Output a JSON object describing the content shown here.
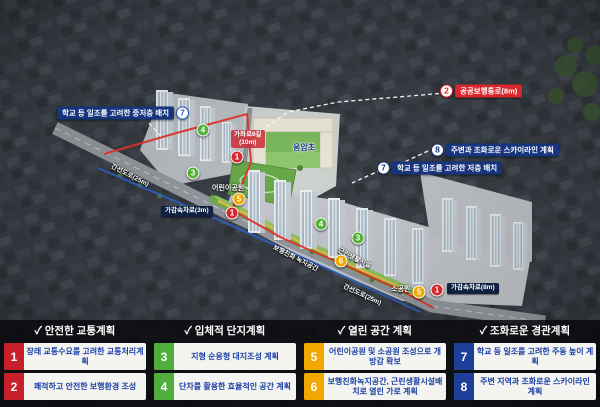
{
  "map": {
    "colors": {
      "red": "#d8272e",
      "green": "#55b03c",
      "yellow": "#f0a700",
      "navy": "#16357d",
      "blue": "#2457b8"
    },
    "markers": [
      {
        "n": "4",
        "color": "green",
        "x": 203,
        "y": 130
      },
      {
        "n": "1",
        "color": "red",
        "x": 237,
        "y": 157
      },
      {
        "n": "3",
        "color": "green",
        "x": 193,
        "y": 173
      },
      {
        "n": "5",
        "color": "yellow",
        "x": 239,
        "y": 199
      },
      {
        "n": "1",
        "color": "red",
        "x": 232,
        "y": 213
      },
      {
        "n": "4",
        "color": "green",
        "x": 321,
        "y": 224
      },
      {
        "n": "3",
        "color": "green",
        "x": 358,
        "y": 238
      },
      {
        "n": "6",
        "color": "yellow",
        "x": 341,
        "y": 261
      },
      {
        "n": "5",
        "color": "yellow",
        "x": 419,
        "y": 292
      },
      {
        "n": "1",
        "color": "red",
        "x": 437,
        "y": 290
      }
    ],
    "callouts": [
      {
        "num": "7",
        "text": "학교 등 일조를 고려한 중저층 배치",
        "x": 57,
        "y": 113,
        "color": "#16357d",
        "num_color": "#2457b8",
        "num_side": "right"
      },
      {
        "num": "2",
        "text": "공공보행통로(8m)",
        "x": 440,
        "y": 91,
        "color": "#d8272e",
        "num_color": "#d8272e",
        "num_side": "left"
      },
      {
        "num": "8",
        "text": "주변과 조화로운 스카이라인 계획",
        "x": 431,
        "y": 150,
        "color": "#16357d",
        "num_color": "#16357d",
        "num_side": "left"
      },
      {
        "num": "7",
        "text": "학교 등 일조를 고려한 저층 배치",
        "x": 377,
        "y": 168,
        "color": "#16357d",
        "num_color": "#16357d",
        "num_side": "left"
      }
    ],
    "road_tags": [
      {
        "text": "가감속차로(3m)",
        "x": 161,
        "y": 206
      },
      {
        "text": "가감속차로(8m)",
        "x": 447,
        "y": 283
      }
    ],
    "road_sign": {
      "line1": "가좌로6길",
      "line2": "(10m)",
      "x": 231,
      "y": 130
    },
    "place_labels": [
      {
        "text": "응암초",
        "x": 293,
        "y": 142,
        "navy": true
      },
      {
        "text": "어린이공원",
        "x": 212,
        "y": 183,
        "navy": false
      },
      {
        "text": "소공원",
        "x": 391,
        "y": 284,
        "navy": false
      }
    ],
    "rotated_labels": [
      {
        "text": "간선도로(25m)",
        "x": 112,
        "y": 160,
        "rot": 27
      },
      {
        "text": "간선도로(25m)",
        "x": 344,
        "y": 280,
        "rot": 25
      },
      {
        "text": "보행친화 녹지공간",
        "x": 274,
        "y": 241,
        "rot": 27
      },
      {
        "text": "근린생활시설",
        "x": 339,
        "y": 244,
        "rot": 27
      }
    ]
  },
  "legend": {
    "check": "✓",
    "sections": [
      {
        "title": "안전한 교통계획",
        "tile_color": "#c8202b",
        "items": [
          {
            "num": "1",
            "text": "장래 교통수요를 고려한 교통처리계획"
          },
          {
            "num": "2",
            "text": "쾌적하고 안전한 보행환경 조성"
          }
        ]
      },
      {
        "title": "입체적 단지계획",
        "tile_color": "#4fae3c",
        "items": [
          {
            "num": "3",
            "text": "지형 순응형 대지조성 계획"
          },
          {
            "num": "4",
            "text": "단차를 활용한 효율적인 공간 계획"
          }
        ]
      },
      {
        "title": "열린 공간 계획",
        "tile_color": "#f0a700",
        "items": [
          {
            "num": "5",
            "text": "어린이공원 및 소공원 조성으로 개방감 확보"
          },
          {
            "num": "6",
            "text": "보행친화녹지공간, 근린생활시설배치로 열린 가로 계획"
          }
        ]
      },
      {
        "title": "조화로운 경관계획",
        "tile_color": "#1e3f97",
        "items": [
          {
            "num": "7",
            "text": "학교 등 일조를 고려한 주동 높이 계획"
          },
          {
            "num": "8",
            "text": "주변 지역과 조화로운 스카이라인 계획"
          }
        ]
      }
    ]
  }
}
